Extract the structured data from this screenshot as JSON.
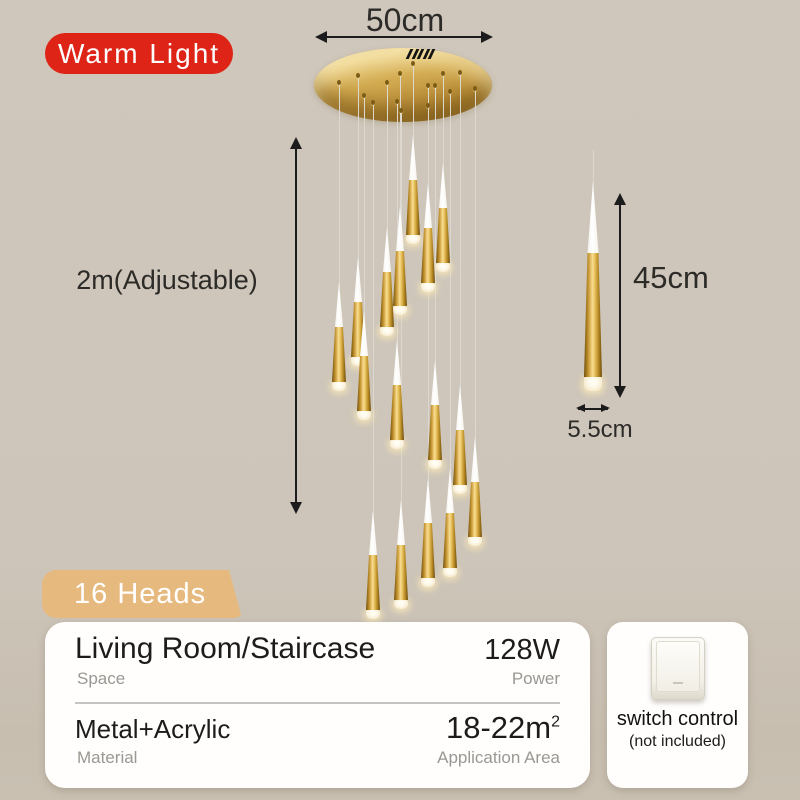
{
  "badge_warm_light": {
    "label": "Warm Light",
    "bg": "#de2416"
  },
  "badge_heads": {
    "label": "16 Heads",
    "bg": "#e6b97e"
  },
  "dimensions": {
    "canopy_width": "50cm",
    "cable_length": "2m(Adjustable)",
    "pendant_height": "45cm",
    "pendant_diameter": "5.5cm"
  },
  "specs": {
    "space": {
      "value": "Living Room/Staircase",
      "label": "Space"
    },
    "power": {
      "value": "128W",
      "label": "Power"
    },
    "material": {
      "value": "Metal+Acrylic",
      "label": "Material"
    },
    "area": {
      "value": "18-22m",
      "unit_sup": "2",
      "label": "Application Area"
    }
  },
  "switch_note": {
    "line1": "switch control",
    "line2": "(not included)"
  },
  "colors": {
    "background": "#cdc5b9",
    "badge_red": "#de2416",
    "badge_tan": "#e6b97e",
    "gold": "#c9972f",
    "panel": "#fffefd",
    "wire": "#dcd8cf"
  },
  "chandelier": {
    "heads": 16,
    "canopy": {
      "left": 314,
      "top": 48,
      "width": 178,
      "height": 74
    },
    "pendant_size": {
      "tip_h": 45,
      "cone_h": 55,
      "cap_h": 9,
      "base_w": 14,
      "neck_w": 8
    },
    "pendants": [
      {
        "x": 413,
        "tip_y": 135,
        "anchor_y": 63
      },
      {
        "x": 443,
        "tip_y": 163,
        "anchor_y": 73
      },
      {
        "x": 428,
        "tip_y": 183,
        "anchor_y": 85
      },
      {
        "x": 400,
        "tip_y": 206,
        "anchor_y": 73
      },
      {
        "x": 387,
        "tip_y": 227,
        "anchor_y": 82
      },
      {
        "x": 358,
        "tip_y": 257,
        "anchor_y": 75
      },
      {
        "x": 339,
        "tip_y": 282,
        "anchor_y": 82
      },
      {
        "x": 364,
        "tip_y": 311,
        "anchor_y": 95
      },
      {
        "x": 397,
        "tip_y": 340,
        "anchor_y": 101
      },
      {
        "x": 435,
        "tip_y": 360,
        "anchor_y": 85
      },
      {
        "x": 460,
        "tip_y": 385,
        "anchor_y": 72
      },
      {
        "x": 475,
        "tip_y": 437,
        "anchor_y": 88
      },
      {
        "x": 450,
        "tip_y": 468,
        "anchor_y": 91
      },
      {
        "x": 428,
        "tip_y": 478,
        "anchor_y": 105
      },
      {
        "x": 373,
        "tip_y": 510,
        "anchor_y": 102
      },
      {
        "x": 401,
        "tip_y": 500,
        "anchor_y": 110
      }
    ],
    "reference_pendant": {
      "x": 593,
      "wire_top": 150,
      "tip_y": 181,
      "tip_h": 72,
      "cone_h": 124,
      "cap_h": 14,
      "base_w": 18,
      "neck_w": 11
    }
  }
}
